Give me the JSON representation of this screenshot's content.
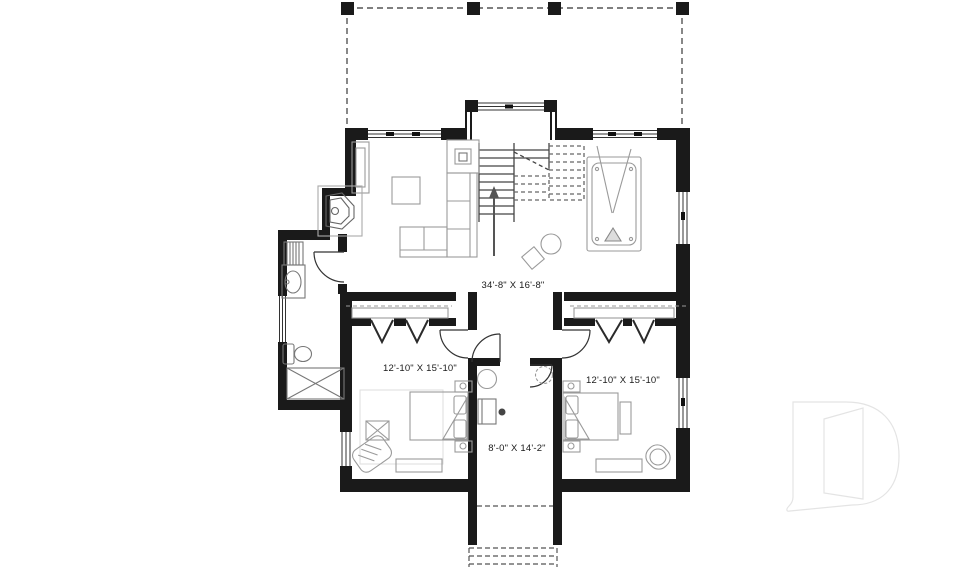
{
  "title": "second-floor-plan",
  "rooms": {
    "family_room": {
      "label": "34'-8\" X 16'-8\""
    },
    "bedroom_left": {
      "label": "12'-10\" X 15'-10\""
    },
    "bedroom_right": {
      "label": "12'-10\" X 15'-10\""
    },
    "hall": {
      "label": "8'-0\" X 14'-2\""
    }
  },
  "colors": {
    "wall": "#1a1a1a",
    "furniture": "#9a9a9a",
    "fixture": "#777777",
    "stairs": "#444444",
    "dashed": "#555555",
    "text": "#1a1a1a",
    "watermark": "#e4e4e4",
    "background": "#ffffff"
  },
  "watermark": {
    "name": "builder-logo-D"
  }
}
